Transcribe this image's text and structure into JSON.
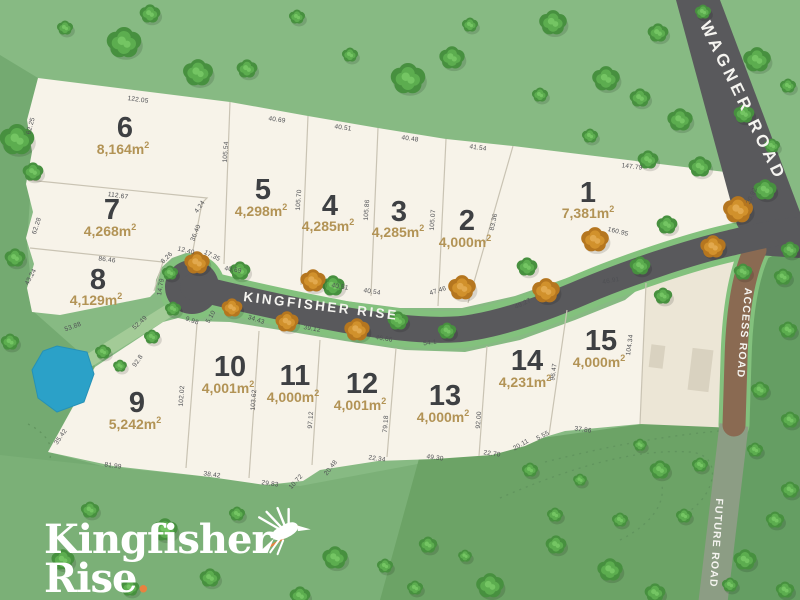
{
  "logo": {
    "line1": "Kingfisher",
    "line2": "Rise",
    "dot": "."
  },
  "roads": [
    {
      "name": "WAGNER ROAD",
      "x": 743,
      "y": 101,
      "rot": 64,
      "size": 17,
      "ls": 4
    },
    {
      "name": "KINGFISHER RISE",
      "x": 321,
      "y": 306,
      "rot": 7,
      "size": 13.5,
      "ls": 2.5
    },
    {
      "name": "ACCESS ROAD",
      "x": 744,
      "y": 333,
      "rot": 95,
      "size": 10.5,
      "ls": 1.2
    },
    {
      "name": "FUTURE ROAD",
      "x": 716,
      "y": 543,
      "rot": 94,
      "size": 10.5,
      "ls": 1.2
    }
  ],
  "lots": [
    {
      "n": "1",
      "area": "7,381m²",
      "nx": 588,
      "ny": 193,
      "ax": 588,
      "ay": 213
    },
    {
      "n": "2",
      "area": "4,000m²",
      "nx": 467,
      "ny": 221,
      "ax": 465,
      "ay": 242
    },
    {
      "n": "3",
      "area": "4,285m²",
      "nx": 399,
      "ny": 212,
      "ax": 398,
      "ay": 232
    },
    {
      "n": "4",
      "area": "4,285m²",
      "nx": 330,
      "ny": 206,
      "ax": 328,
      "ay": 226
    },
    {
      "n": "5",
      "area": "4,298m²",
      "nx": 263,
      "ny": 190,
      "ax": 261,
      "ay": 211
    },
    {
      "n": "6",
      "area": "8,164m²",
      "nx": 125,
      "ny": 128,
      "ax": 123,
      "ay": 149
    },
    {
      "n": "7",
      "area": "4,268m²",
      "nx": 112,
      "ny": 210,
      "ax": 110,
      "ay": 231
    },
    {
      "n": "8",
      "area": "4,129m²",
      "nx": 98,
      "ny": 280,
      "ax": 96,
      "ay": 300
    },
    {
      "n": "9",
      "area": "5,242m²",
      "nx": 137,
      "ny": 403,
      "ax": 135,
      "ay": 424
    },
    {
      "n": "10",
      "area": "4,001m²",
      "nx": 230,
      "ny": 367,
      "ax": 228,
      "ay": 388
    },
    {
      "n": "11",
      "area": "4,000m²",
      "nx": 295,
      "ny": 376,
      "ax": 293,
      "ay": 397
    },
    {
      "n": "12",
      "area": "4,001m²",
      "nx": 362,
      "ny": 384,
      "ax": 360,
      "ay": 405
    },
    {
      "n": "13",
      "area": "4,000m²",
      "nx": 445,
      "ny": 396,
      "ax": 443,
      "ay": 417
    },
    {
      "n": "14",
      "area": "4,231m²",
      "nx": 527,
      "ny": 361,
      "ax": 525,
      "ay": 382
    },
    {
      "n": "15",
      "area": "4,000m²",
      "nx": 601,
      "ny": 341,
      "ax": 599,
      "ay": 362
    }
  ],
  "measurements": [
    {
      "t": "122.05",
      "x": 138,
      "y": 100,
      "r": 8
    },
    {
      "t": "62.25",
      "x": 31,
      "y": 126,
      "r": -75
    },
    {
      "t": "112.67",
      "x": 118,
      "y": 196,
      "r": 8
    },
    {
      "t": "62.28",
      "x": 37,
      "y": 226,
      "r": -72
    },
    {
      "t": "86.46",
      "x": 107,
      "y": 260,
      "r": 7
    },
    {
      "t": "43.24",
      "x": 31,
      "y": 277,
      "r": -62
    },
    {
      "t": "4.24",
      "x": 200,
      "y": 207,
      "r": -55
    },
    {
      "t": "36.40",
      "x": 196,
      "y": 233,
      "r": -68
    },
    {
      "t": "8.26",
      "x": 167,
      "y": 258,
      "r": -45
    },
    {
      "t": "12.40",
      "x": 186,
      "y": 251,
      "r": 14
    },
    {
      "t": "17.35",
      "x": 212,
      "y": 256,
      "r": 26
    },
    {
      "t": "14.79",
      "x": 161,
      "y": 287,
      "r": -80
    },
    {
      "t": "40.69",
      "x": 277,
      "y": 120,
      "r": 8
    },
    {
      "t": "105.54",
      "x": 226,
      "y": 152,
      "r": -86
    },
    {
      "t": "40.51",
      "x": 343,
      "y": 128,
      "r": 8
    },
    {
      "t": "105.70",
      "x": 299,
      "y": 200,
      "r": -86
    },
    {
      "t": "40.48",
      "x": 410,
      "y": 139,
      "r": 8
    },
    {
      "t": "105.86",
      "x": 367,
      "y": 210,
      "r": -86
    },
    {
      "t": "41.54",
      "x": 478,
      "y": 148,
      "r": 8
    },
    {
      "t": "105.07",
      "x": 433,
      "y": 220,
      "r": -86
    },
    {
      "t": "83.36",
      "x": 494,
      "y": 222,
      "r": -78
    },
    {
      "t": "147.79",
      "x": 632,
      "y": 167,
      "r": 7
    },
    {
      "t": "20.92",
      "x": 752,
      "y": 196,
      "r": -66
    },
    {
      "t": "160.95",
      "x": 618,
      "y": 232,
      "r": 14
    },
    {
      "t": "40.69",
      "x": 233,
      "y": 270,
      "r": 9
    },
    {
      "t": "40.51",
      "x": 340,
      "y": 287,
      "r": 9
    },
    {
      "t": "40.54",
      "x": 372,
      "y": 292,
      "r": 9
    },
    {
      "t": "47.46",
      "x": 438,
      "y": 291,
      "r": -18
    },
    {
      "t": "46.91",
      "x": 611,
      "y": 281,
      "r": -10
    },
    {
      "t": "9.98",
      "x": 192,
      "y": 321,
      "r": 20
    },
    {
      "t": "5.10",
      "x": 211,
      "y": 317,
      "r": -60
    },
    {
      "t": "34.43",
      "x": 256,
      "y": 320,
      "r": 18
    },
    {
      "t": "39.12",
      "x": 312,
      "y": 329,
      "r": 10
    },
    {
      "t": "46.66",
      "x": 384,
      "y": 339,
      "r": 9
    },
    {
      "t": "54.1",
      "x": 430,
      "y": 343,
      "r": -8
    },
    {
      "t": "49.27",
      "x": 523,
      "y": 304,
      "r": -26
    },
    {
      "t": "102.02",
      "x": 182,
      "y": 396,
      "r": -86
    },
    {
      "t": "103.62",
      "x": 254,
      "y": 400,
      "r": -86
    },
    {
      "t": "97.12",
      "x": 311,
      "y": 420,
      "r": -86
    },
    {
      "t": "79.18",
      "x": 386,
      "y": 424,
      "r": -86
    },
    {
      "t": "92.00",
      "x": 479,
      "y": 420,
      "r": -86
    },
    {
      "t": "96.47",
      "x": 554,
      "y": 372,
      "r": -82
    },
    {
      "t": "104.34",
      "x": 630,
      "y": 345,
      "r": -82
    },
    {
      "t": "35.42",
      "x": 61,
      "y": 437,
      "r": -55
    },
    {
      "t": "81.99",
      "x": 113,
      "y": 466,
      "r": 8
    },
    {
      "t": "38.42",
      "x": 212,
      "y": 475,
      "r": 8
    },
    {
      "t": "29.83",
      "x": 270,
      "y": 484,
      "r": 8
    },
    {
      "t": "10.72",
      "x": 296,
      "y": 482,
      "r": -48
    },
    {
      "t": "20.48",
      "x": 331,
      "y": 468,
      "r": -52
    },
    {
      "t": "22.34",
      "x": 377,
      "y": 459,
      "r": 8
    },
    {
      "t": "49.30",
      "x": 435,
      "y": 458,
      "r": 8
    },
    {
      "t": "22.70",
      "x": 492,
      "y": 454,
      "r": 8
    },
    {
      "t": "20.11",
      "x": 521,
      "y": 445,
      "r": -30
    },
    {
      "t": "5.55",
      "x": 543,
      "y": 436,
      "r": -28
    },
    {
      "t": "37.86",
      "x": 583,
      "y": 430,
      "r": 8
    },
    {
      "t": "92.8",
      "x": 138,
      "y": 361,
      "r": -55
    },
    {
      "t": "52.49",
      "x": 140,
      "y": 323,
      "r": -42
    },
    {
      "t": "53.88",
      "x": 73,
      "y": 327,
      "r": -20
    }
  ],
  "trees": {
    "green": [
      [
        17,
        140,
        15
      ],
      [
        33,
        172,
        9
      ],
      [
        15,
        258,
        9
      ],
      [
        10,
        342,
        8
      ],
      [
        124,
        43,
        15
      ],
      [
        150,
        14,
        9
      ],
      [
        198,
        73,
        13
      ],
      [
        247,
        69,
        9
      ],
      [
        297,
        17,
        7
      ],
      [
        350,
        55,
        7
      ],
      [
        408,
        79,
        15
      ],
      [
        452,
        58,
        11
      ],
      [
        470,
        25,
        7
      ],
      [
        553,
        23,
        12
      ],
      [
        606,
        79,
        12
      ],
      [
        640,
        98,
        9
      ],
      [
        658,
        33,
        9
      ],
      [
        680,
        120,
        11
      ],
      [
        703,
        12,
        7
      ],
      [
        757,
        60,
        12
      ],
      [
        744,
        114,
        9
      ],
      [
        788,
        86,
        7
      ],
      [
        590,
        136,
        7
      ],
      [
        648,
        160,
        9
      ],
      [
        700,
        167,
        10
      ],
      [
        772,
        146,
        7
      ],
      [
        540,
        95,
        7
      ],
      [
        65,
        28,
        7
      ],
      [
        240,
        271,
        9
      ],
      [
        333,
        286,
        10
      ],
      [
        398,
        321,
        9
      ],
      [
        447,
        331,
        8
      ],
      [
        527,
        267,
        9
      ],
      [
        640,
        266,
        9
      ],
      [
        663,
        296,
        8
      ],
      [
        667,
        225,
        9
      ],
      [
        743,
        272,
        8
      ],
      [
        783,
        277,
        8
      ],
      [
        170,
        273,
        7
      ],
      [
        173,
        309,
        7
      ],
      [
        152,
        337,
        7
      ],
      [
        103,
        352,
        7
      ],
      [
        120,
        366,
        6
      ],
      [
        90,
        510,
        8
      ],
      [
        63,
        560,
        10
      ],
      [
        130,
        588,
        8
      ],
      [
        165,
        530,
        11
      ],
      [
        210,
        578,
        9
      ],
      [
        237,
        514,
        7
      ],
      [
        300,
        596,
        9
      ],
      [
        335,
        558,
        11
      ],
      [
        385,
        566,
        7
      ],
      [
        428,
        545,
        8
      ],
      [
        490,
        586,
        12
      ],
      [
        530,
        470,
        7
      ],
      [
        556,
        545,
        9
      ],
      [
        580,
        480,
        6
      ],
      [
        610,
        570,
        11
      ],
      [
        655,
        593,
        9
      ],
      [
        684,
        516,
        7
      ],
      [
        745,
        560,
        10
      ],
      [
        775,
        520,
        8
      ],
      [
        785,
        590,
        8
      ],
      [
        730,
        585,
        7
      ],
      [
        415,
        588,
        7
      ],
      [
        465,
        556,
        6
      ],
      [
        555,
        515,
        7
      ],
      [
        620,
        520,
        7
      ],
      [
        765,
        190,
        10
      ],
      [
        790,
        250,
        8
      ],
      [
        788,
        330,
        8
      ],
      [
        760,
        390,
        8
      ],
      [
        790,
        420,
        8
      ],
      [
        755,
        450,
        7
      ],
      [
        790,
        490,
        8
      ],
      [
        640,
        445,
        6
      ],
      [
        660,
        470,
        9
      ],
      [
        700,
        465,
        7
      ]
    ],
    "orange": [
      [
        197,
        263,
        11
      ],
      [
        232,
        308,
        9
      ],
      [
        287,
        322,
        10
      ],
      [
        313,
        281,
        11
      ],
      [
        357,
        330,
        11
      ],
      [
        462,
        288,
        12
      ],
      [
        546,
        291,
        12
      ],
      [
        595,
        240,
        12
      ],
      [
        713,
        247,
        11
      ],
      [
        738,
        210,
        13
      ]
    ]
  },
  "pond": [
    [
      57,
      346
    ],
    [
      87,
      352
    ],
    [
      94,
      374
    ],
    [
      84,
      402
    ],
    [
      57,
      412
    ],
    [
      38,
      398
    ],
    [
      32,
      370
    ],
    [
      43,
      351
    ]
  ],
  "buildings": [
    {
      "x": 650,
      "y": 345,
      "w": 14,
      "h": 23,
      "rot": 7
    },
    {
      "x": 690,
      "y": 349,
      "w": 21,
      "h": 42,
      "rot": 7
    }
  ],
  "colors": {
    "base_green": "#87ba83",
    "green_left": "#74aa71",
    "green_below": "#7bb077",
    "green_band": "#6ca366",
    "green_right": "#659e63",
    "cream": "#f7f3e9",
    "beige": "#ece6d6",
    "boundary": "#c9c3b3",
    "road_gray": "#59595c",
    "casing_green": "#83c17d",
    "strip_green": "#a3cb97",
    "access_brown": "#8a6a52",
    "future_road": "#8c9d84",
    "pond_blue": "#2ba1c8",
    "pond_edge": "#2691b6",
    "building": "#d9d2c0",
    "lot_number": "#3e4043",
    "lot_area": "#b29355",
    "measurement": "#4f5054",
    "label_white": "#f5f4f0",
    "logo_white": "#ffffff",
    "logo_orange": "#e8823f",
    "trail": "#5f925d",
    "tree_green": {
      "base": "#47903f",
      "mid": "#5cad4f",
      "light": "#74c563"
    },
    "tree_orange": {
      "base": "#b5761f",
      "mid": "#d1912c",
      "light": "#e2a94e"
    }
  }
}
